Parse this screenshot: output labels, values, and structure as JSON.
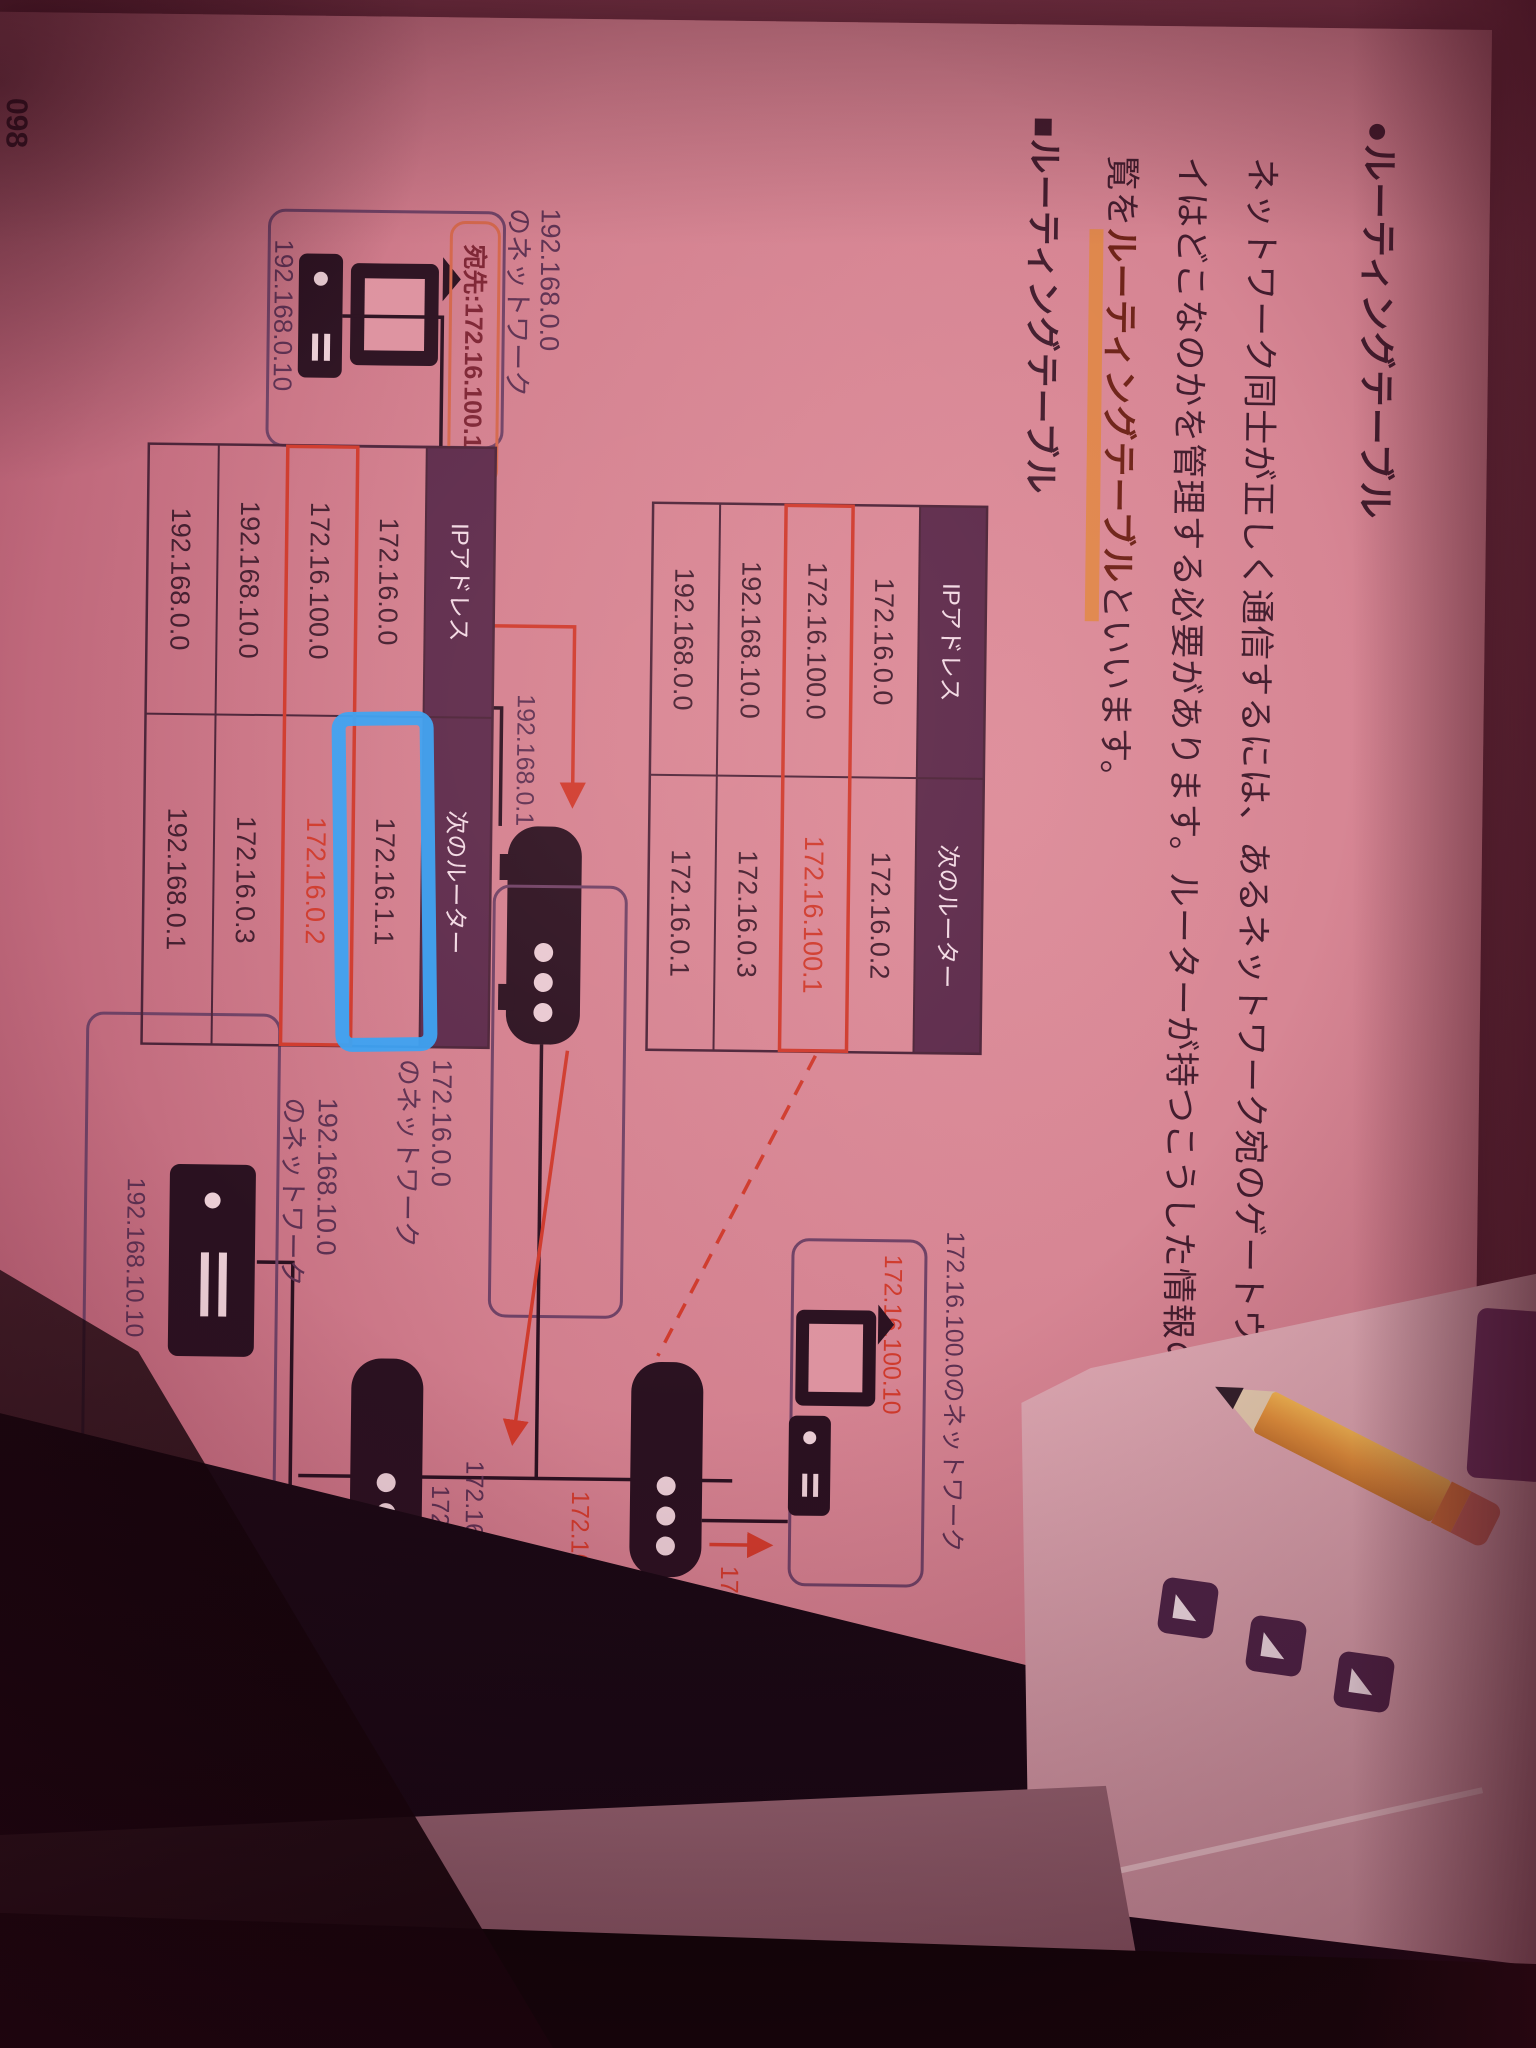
{
  "page_number": "098",
  "heading": "●ルーティングテーブル",
  "body": {
    "line1": "ネットワーク同士が正しく通信するには、あるネットワーク宛のゲートウェ",
    "line2": "イはどこなのかを管理する必要があります。ルーターが持つこうした情報の一",
    "line3_pre": "覧を",
    "line3_highlight": "ルーティングテーブル",
    "line3_post": "といいます。"
  },
  "section_title": "■ルーティングテーブル",
  "callout": "宛先:172.16.100.10",
  "networks": {
    "a_line1": "192.168.0.0",
    "a_line2": "のネットワーク",
    "c_line1": "172.16.0.0",
    "c_line2": "のネットワーク",
    "b_label": "172.16.100.0のネットワーク",
    "d_line1": "192.168.10.0",
    "d_line2": "のネットワーク"
  },
  "hosts": {
    "pc_a": "192.168.0.10",
    "pc_b": "172.16.100.10",
    "server": "192.168.10.10"
  },
  "interfaces": {
    "r1_lan": "192.168.0.1",
    "r1_wan": "172.16.0.1",
    "r2_wan": "172.16.0.2",
    "r2_lan": "172.16.100.1",
    "r3_wan": "172.16.0.3",
    "r3_lan": "192.168.10.1"
  },
  "tables": {
    "upper": {
      "headers": [
        "IPアドレス",
        "次のルーター"
      ],
      "rows": [
        [
          "172.16.0.0",
          "172.16.0.2"
        ],
        [
          "172.16.100.0",
          "172.16.100.1"
        ],
        [
          "192.168.10.0",
          "172.16.0.3"
        ],
        [
          "192.168.0.0",
          "172.16.0.1"
        ]
      ],
      "highlight_row": 1
    },
    "lower": {
      "headers": [
        "IPアドレス",
        "次のルーター"
      ],
      "rows": [
        [
          "172.16.0.0",
          "172.16.1.1"
        ],
        [
          "172.16.100.0",
          "172.16.0.2"
        ],
        [
          "192.168.10.0",
          "172.16.0.3"
        ],
        [
          "192.168.0.0",
          "192.168.0.1"
        ]
      ],
      "highlight_row": 1,
      "marker_cell": "172.16.1.1"
    }
  },
  "colors": {
    "ink": "#421d2e",
    "purple_label": "#5c3051",
    "table_header_bg": "#5b2a4b",
    "table_line": "#4a2338",
    "print_red": "#cf3a2c",
    "highlight_orange": "#e0873f",
    "callout_border": "#d4674b",
    "box_border": "#6e4165",
    "blue_marker": "#37a2f4",
    "icon_black": "#2a1120"
  }
}
